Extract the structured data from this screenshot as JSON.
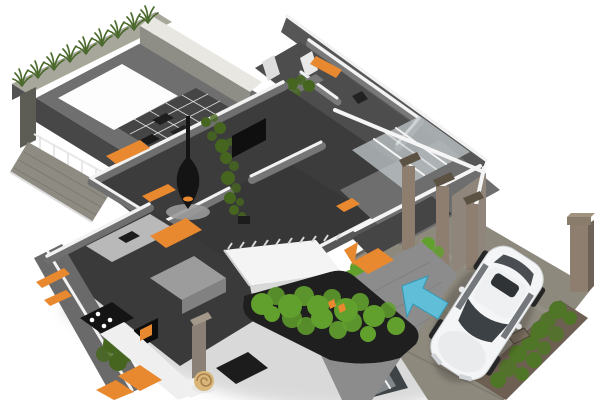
{
  "window": {
    "width": 600,
    "height": 400,
    "background": "#ffffff"
  },
  "scene": {
    "type": "3d-isometric-cutaway-floor-plan-render",
    "elements": [
      "roof-terrace-with-grass-planter-parapet",
      "skylight-opening",
      "glazed-grid-partition",
      "terrace-railing",
      "living-room-with-hanging-fireplace",
      "indoor-climbing-plant",
      "wall-mounted-tv-panel",
      "white-staircase",
      "large-dark-planter-with-shrubs",
      "kitchen-with-cooktop-and-island",
      "orange-accent-benches-rugs-shelves",
      "entry-porch-with-taupe-pillars-and-glass",
      "winter-garden-shelving",
      "beige-spiral-sculpture",
      "driveway",
      "white-hatchback-car",
      "blue-direction-arrow",
      "hedge-wall-with-posts",
      "gate-post"
    ]
  },
  "palette": {
    "background": "#ffffff",
    "wall_gray": "#6a6a6a",
    "wall_cap_white": "#f2f2f2",
    "floor_charcoal": "#3c3c3c",
    "floor_gray": "#8c8c8c",
    "accent_orange": "#e8882f",
    "grass_green": "#4a6b2d",
    "plant_green_dark": "#46661f",
    "plant_green_bright": "#62a02e",
    "foliage_hedge": "#4f7526",
    "car_white": "#f4f5f6",
    "car_glass": "#3c4145",
    "arrow_blue": "#5ec1dd",
    "pillar_taupe": "#8d7e6f",
    "hedge_wall_brown": "#6d5f52",
    "driveway_gray": "#8e897d",
    "skylight_white": "#fdfdfd",
    "fireplace_black": "#141414",
    "shadow_gray": "#b5b5b5"
  }
}
